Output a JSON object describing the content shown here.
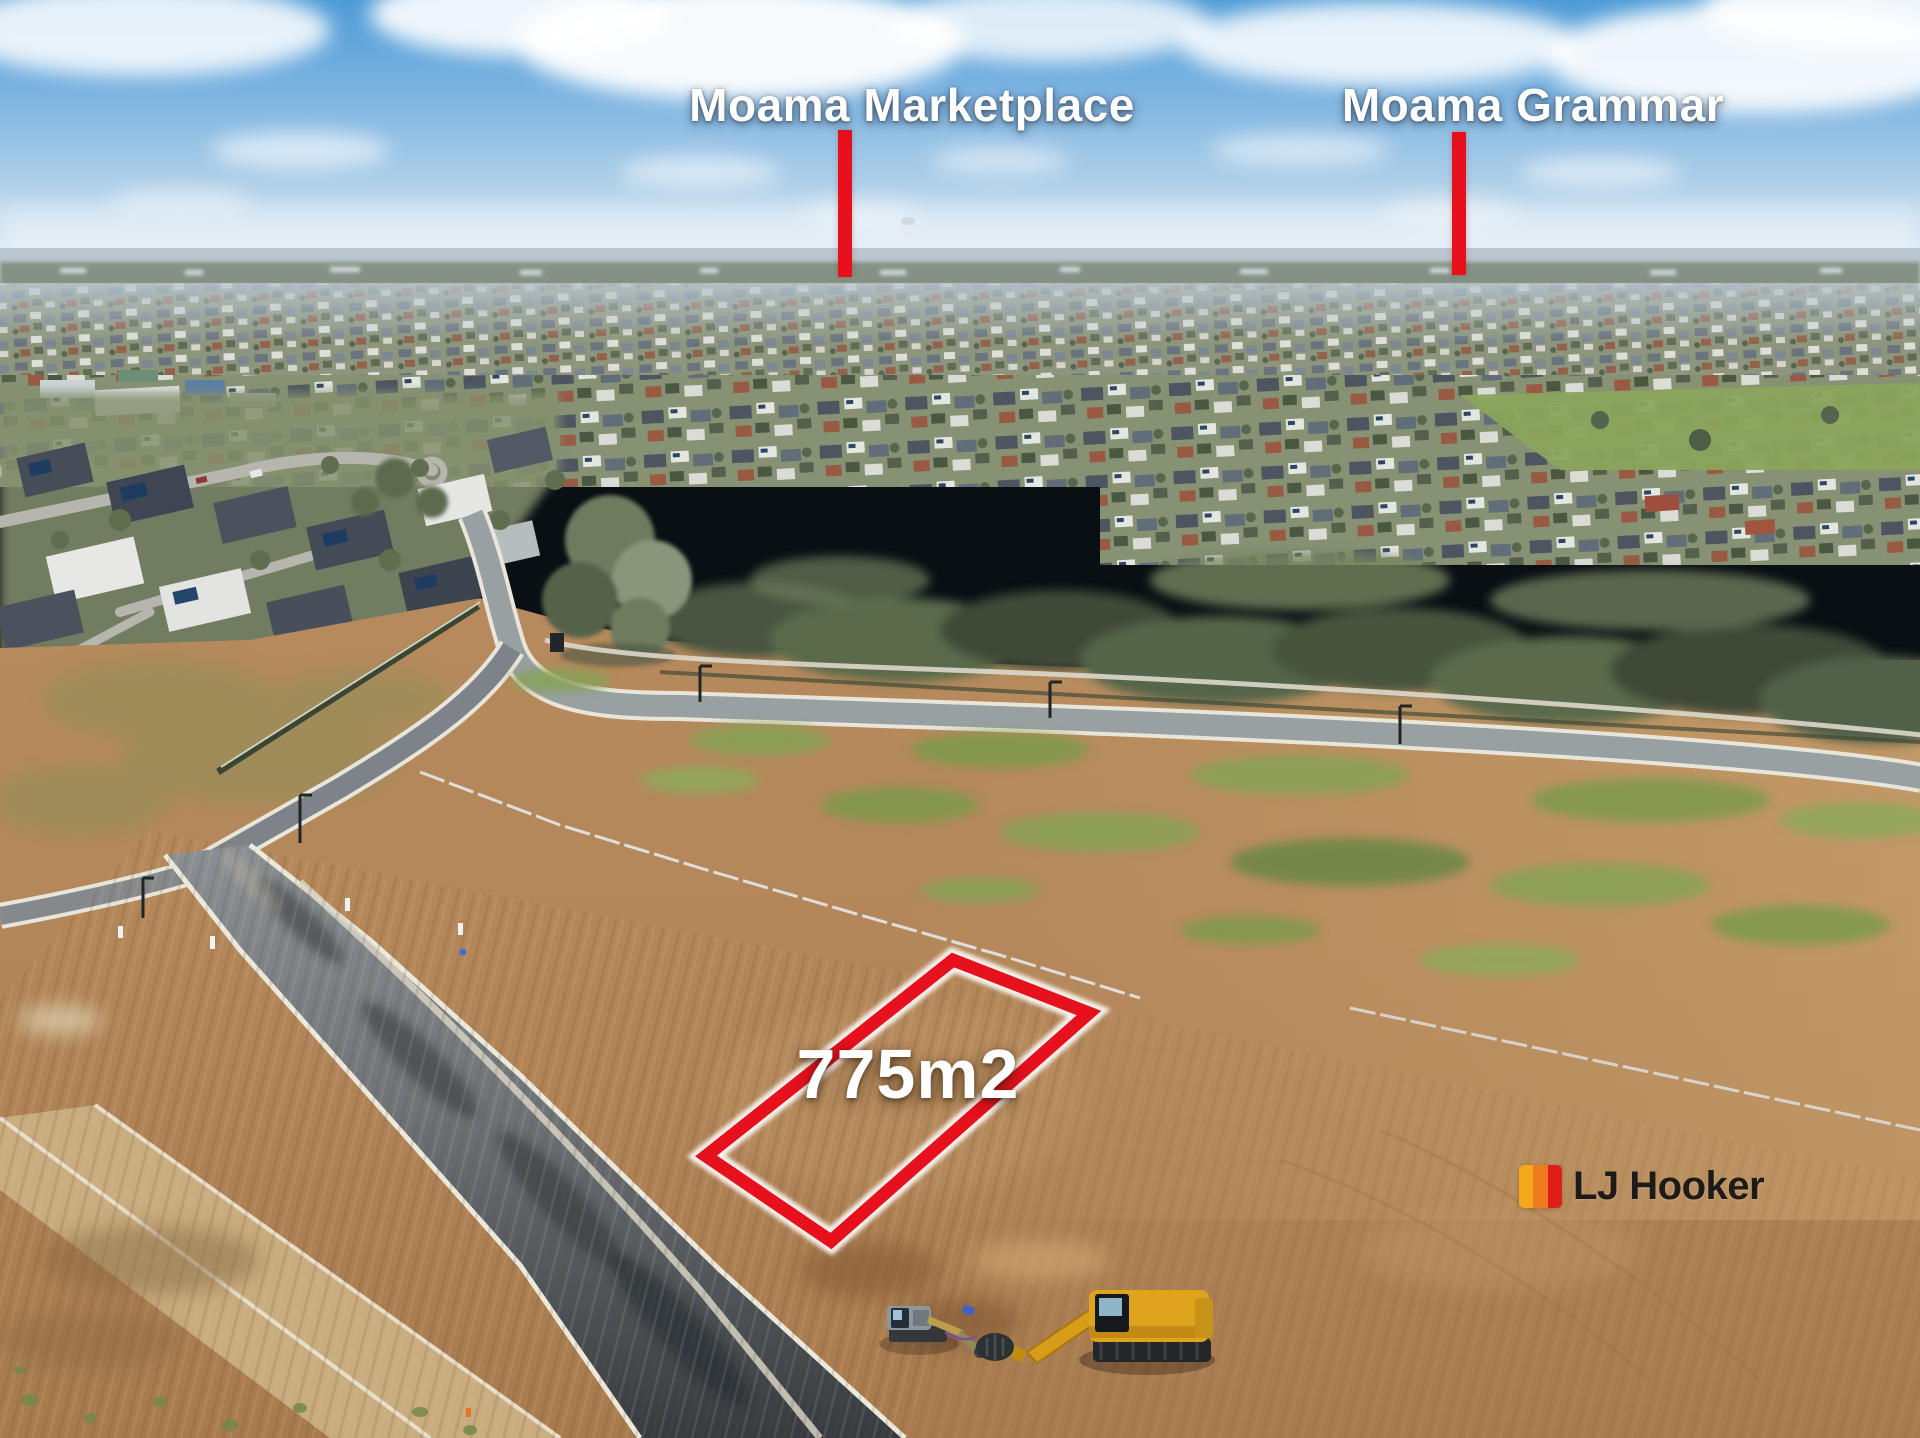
{
  "annotations": {
    "marker_color": "#e7101d",
    "label_color": "#ffffff",
    "poi_markers": [
      {
        "label": "Moama Marketplace"
      },
      {
        "label": "Moama Grammar"
      }
    ],
    "lot": {
      "area_label": "775m2",
      "outline_color": "#e7101d"
    }
  },
  "branding": {
    "agency_name": "LJ Hooker",
    "logo_bar_colors": [
      "#f3a81c",
      "#ee7c1e",
      "#df1f17"
    ],
    "logo_text_color": "#1d1a18"
  }
}
